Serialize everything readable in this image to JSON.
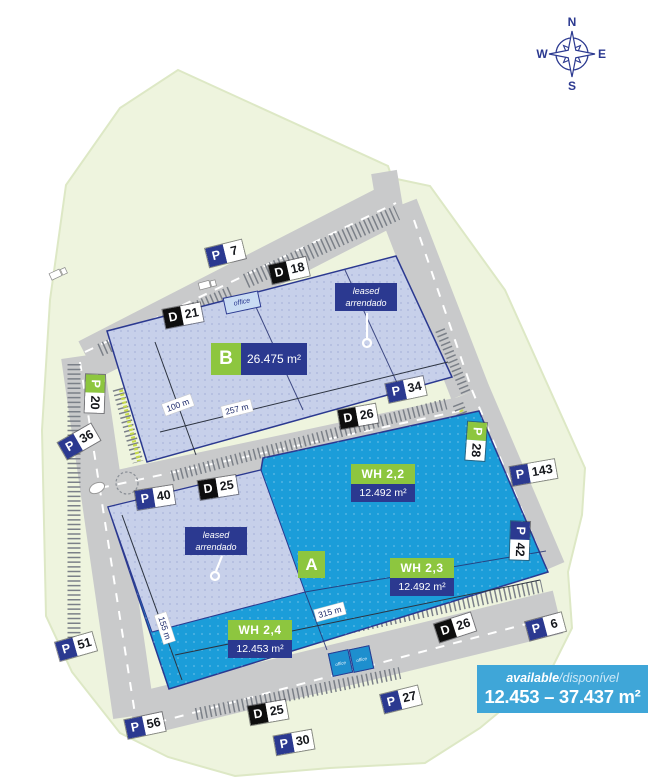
{
  "compass": {
    "n": "N",
    "e": "E",
    "s": "S",
    "w": "W"
  },
  "buildings": {
    "b": {
      "code": "B",
      "area": "26.475 m²"
    },
    "a": {
      "code": "A"
    },
    "wh22": {
      "name": "WH 2,2",
      "area": "12.492 m²"
    },
    "wh23": {
      "name": "WH 2,3",
      "area": "12.492 m²"
    },
    "wh24": {
      "name": "WH 2,4",
      "area": "12.453 m²"
    }
  },
  "leased_label": {
    "line1": "leased",
    "line2": "arrendado"
  },
  "office_label": "office",
  "dimensions": {
    "b_depth": "100 m",
    "b_length": "257 m",
    "a_depth": "155 m",
    "a_length": "315 m"
  },
  "badges": {
    "p7": {
      "letter": "P",
      "number": "7"
    },
    "d18": {
      "letter": "D",
      "number": "18"
    },
    "d21": {
      "letter": "D",
      "number": "21"
    },
    "p20": {
      "letter": "P",
      "number": "20"
    },
    "p36": {
      "letter": "P",
      "number": "36"
    },
    "p34": {
      "letter": "P",
      "number": "34"
    },
    "d26_mid": {
      "letter": "D",
      "number": "26"
    },
    "p28": {
      "letter": "P",
      "number": "28"
    },
    "p143": {
      "letter": "P",
      "number": "143"
    },
    "d25_mid": {
      "letter": "D",
      "number": "25"
    },
    "p40": {
      "letter": "P",
      "number": "40"
    },
    "p42": {
      "letter": "P",
      "number": "42"
    },
    "d26_bottom": {
      "letter": "D",
      "number": "26"
    },
    "p6": {
      "letter": "P",
      "number": "6"
    },
    "p51": {
      "letter": "P",
      "number": "51"
    },
    "d25_bottom": {
      "letter": "D",
      "number": "25"
    },
    "p27": {
      "letter": "P",
      "number": "27"
    },
    "p56": {
      "letter": "P",
      "number": "56"
    },
    "p30": {
      "letter": "P",
      "number": "30"
    }
  },
  "availability": {
    "label_en": "available",
    "label_pt": "/disponível",
    "range": "12.453 – 37.437 m²"
  },
  "colors": {
    "navy": "#2b3990",
    "green": "#8dc63f",
    "warehouse_blue": "#1b9dd9",
    "leased_lavender": "#c7d0ea",
    "available_blue": "#3fa6d8",
    "site_green": "#eef4de",
    "road_gray": "#c9cacb"
  }
}
